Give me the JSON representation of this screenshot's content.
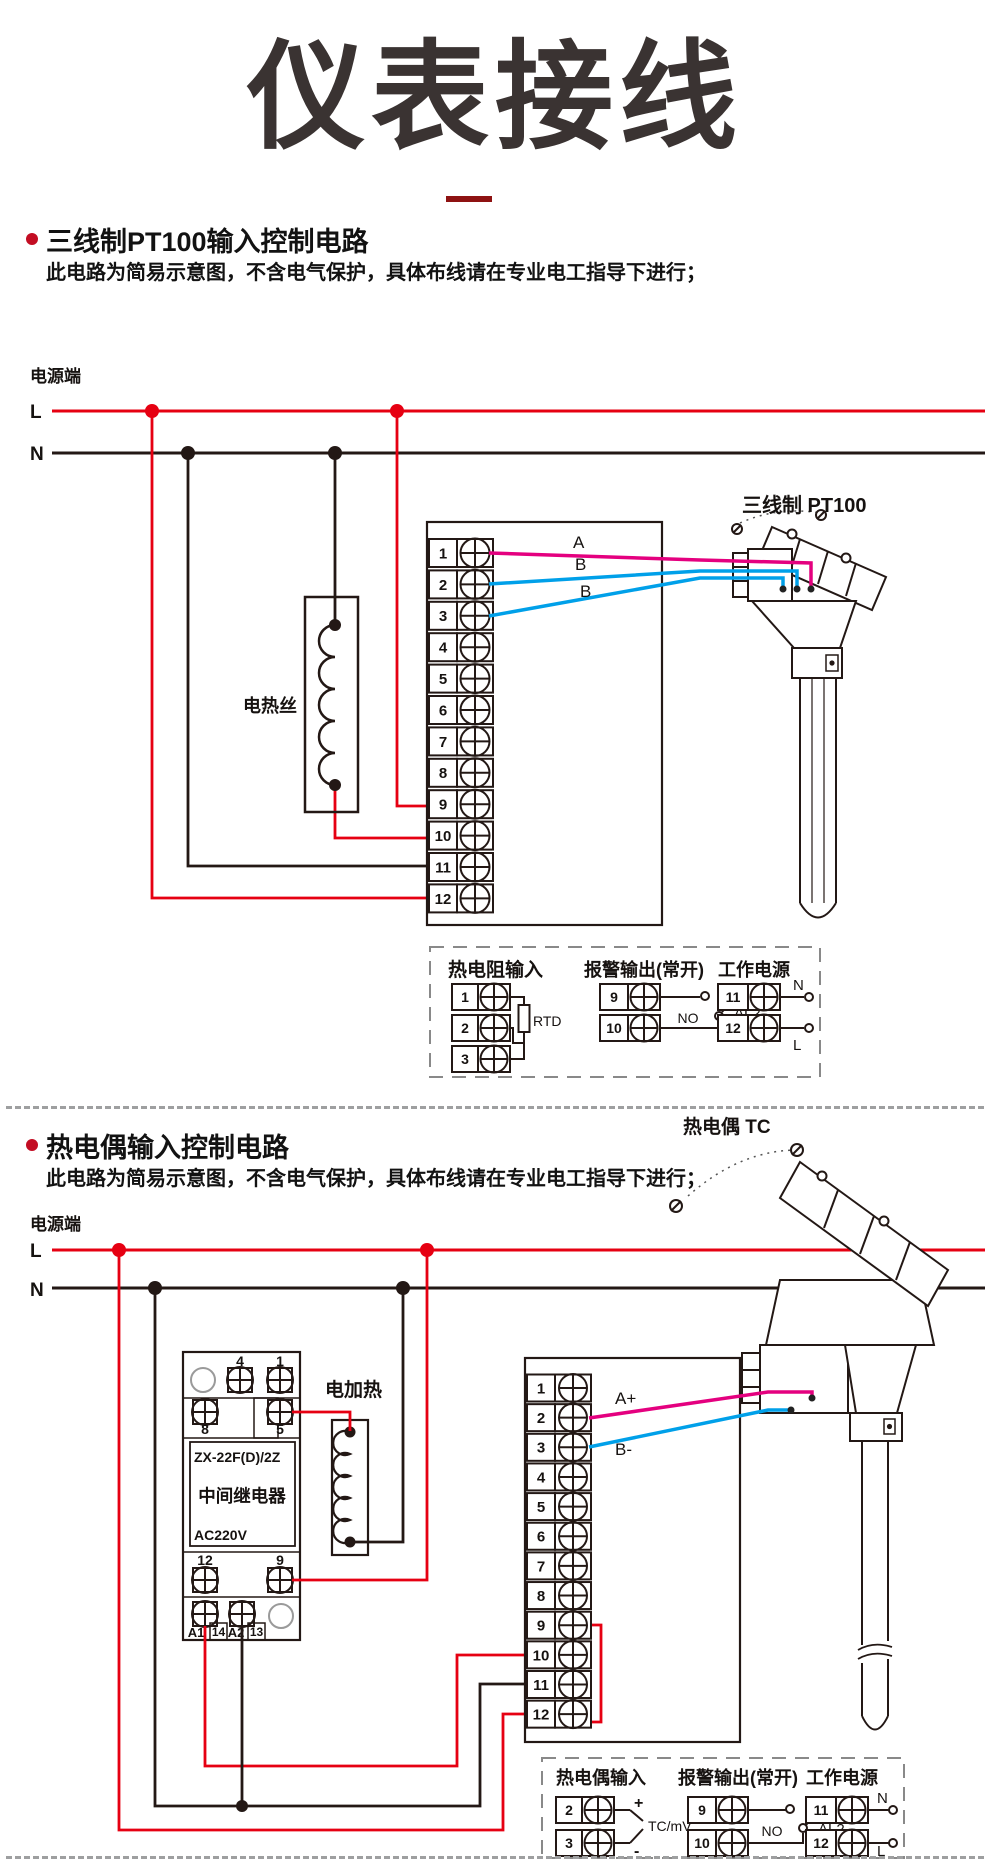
{
  "title": {
    "text": "仪表接线"
  },
  "sections": [
    {
      "heading": "三线制PT100输入控制电路",
      "note": "此电路为简易示意图，不含电气保护，具体布线请在专业电工指导下进行；"
    },
    {
      "heading": "热电偶输入控制电路",
      "note": "此电路为简易示意图，不含电气保护，具体布线请在专业电工指导下进行；"
    }
  ],
  "colors": {
    "bus_live_red": "#e60012",
    "bus_neutral_black": "#231815",
    "wire_pink": "#e4007f",
    "wire_blue": "#00a0e9",
    "title_dark": "#3a3332",
    "accent_dark_red": "#8e1212",
    "bullet_red": "#c30d23",
    "separator_gray": "#9e9fa0",
    "legend_dash_gray": "#898989"
  },
  "diagram1": {
    "power_label": "电源端",
    "l": "L",
    "n": "N",
    "heater": "电热丝",
    "sensor": "三线制 PT100",
    "wires": [
      "A",
      "B",
      "B"
    ],
    "terminals": [
      "1",
      "2",
      "3",
      "4",
      "5",
      "6",
      "7",
      "8",
      "9",
      "10",
      "11",
      "12"
    ],
    "legend": {
      "rtd": {
        "title": "热电阻输入",
        "terminals": [
          "1",
          "2",
          "3"
        ],
        "device": "RTD"
      },
      "alarm": {
        "title": "报警输出(常开)",
        "terminals": [
          "9",
          "10"
        ],
        "no": "NO",
        "al": "AL2"
      },
      "power": {
        "title": "工作电源",
        "terminals": [
          "11",
          "12"
        ],
        "n": "N",
        "l": "L"
      }
    }
  },
  "diagram2": {
    "power_label": "电源端",
    "l": "L",
    "n": "N",
    "heater": "电加热",
    "sensor": "热电偶 TC",
    "wires": [
      "A+",
      "B-"
    ],
    "relay": {
      "model": "ZX-22F(D)/2Z",
      "name": "中间继电器",
      "voltage": "AC220V",
      "top": [
        "4",
        "1"
      ],
      "mid": [
        "8",
        "5"
      ],
      "bot": [
        "12",
        "9"
      ],
      "coil": [
        "A1",
        "14",
        "A2",
        "13"
      ]
    },
    "terminals": [
      "1",
      "2",
      "3",
      "4",
      "5",
      "6",
      "7",
      "8",
      "9",
      "10",
      "11",
      "12"
    ],
    "legend": {
      "tc": {
        "title": "热电偶输入",
        "terminals": [
          "2",
          "3"
        ],
        "plus": "+",
        "minus": "-",
        "device": "TC/mV"
      },
      "alarm": {
        "title": "报警输出(常开)",
        "terminals": [
          "9",
          "10"
        ],
        "no": "NO",
        "al": "AL2"
      },
      "power": {
        "title": "工作电源",
        "terminals": [
          "11",
          "12"
        ],
        "n": "N",
        "l": "L"
      }
    }
  }
}
